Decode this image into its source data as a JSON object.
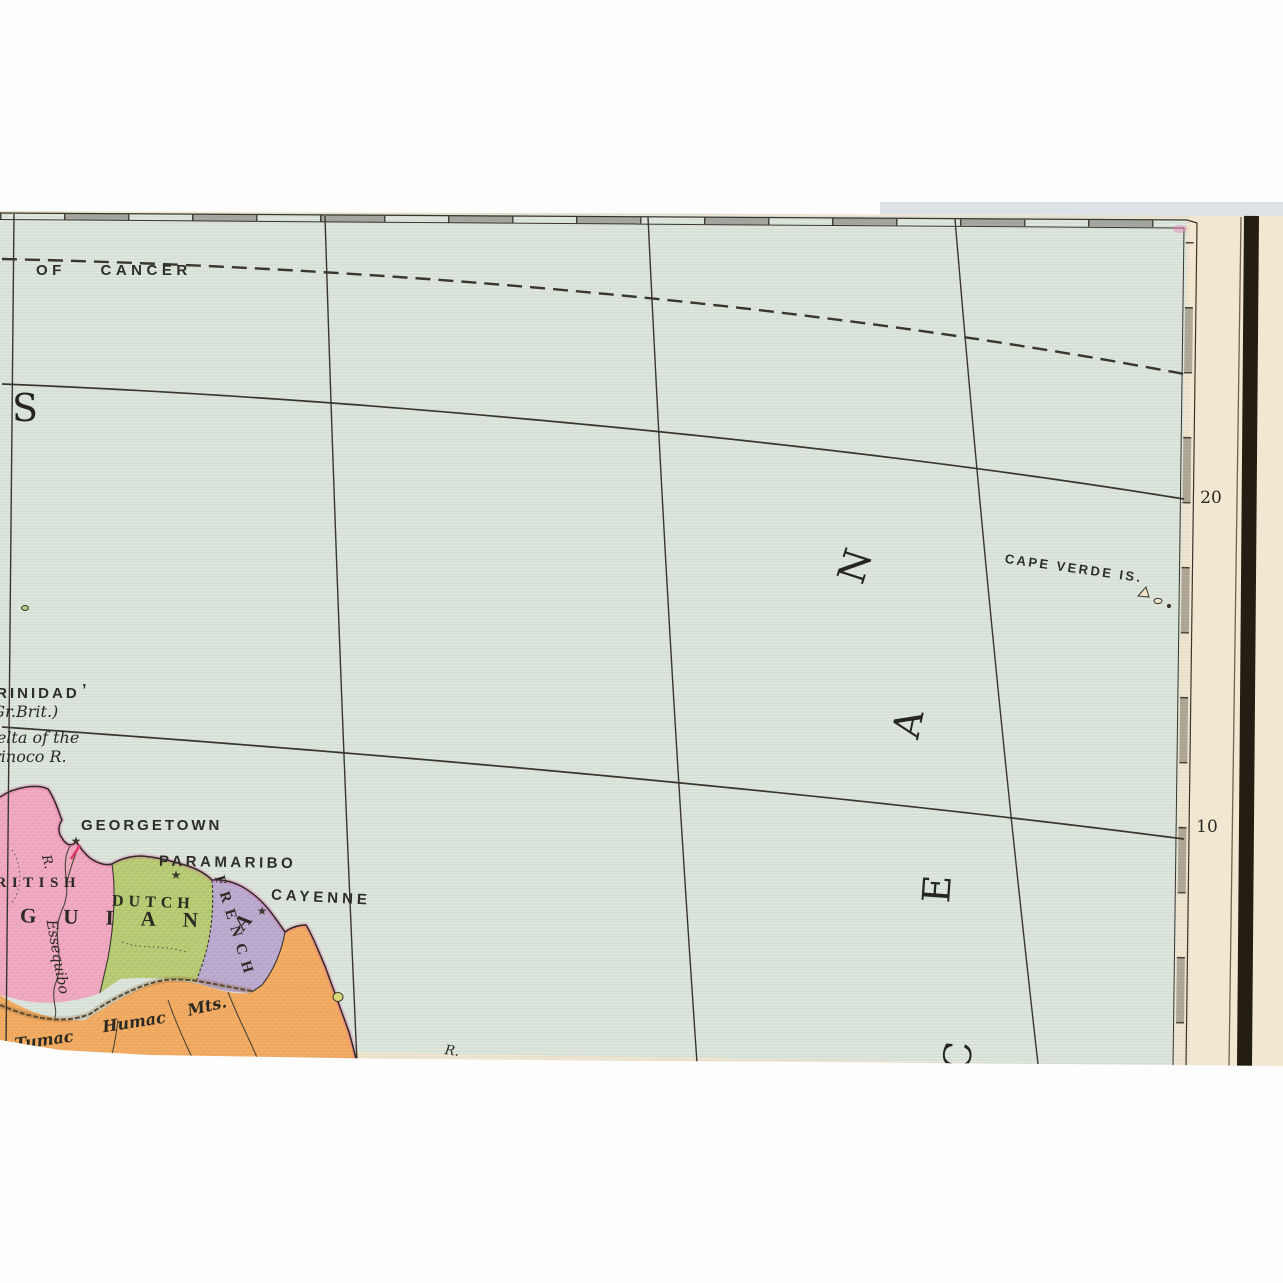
{
  "title": "Antique atlas map fragment - Guiana coast and North Atlantic",
  "colors": {
    "photo_bg": "#ffffff",
    "paper_cream": "#f2e8d2",
    "ocean_green": "#dfe9e0",
    "british_guiana_pink": "#f6acc5",
    "dutch_guiana_green": "#bcd077",
    "french_guiana_purple": "#c0aed4",
    "brazil_orange": "#f8ae63",
    "line_ink": "#36322a",
    "binding_bar_black": "#241d13",
    "coast_tint_magenta": "#e060a8",
    "georgetown_mark_red": "#e23a68"
  },
  "graticule": {
    "tropic_label": "OF CANCER",
    "lat_labels": [
      "20",
      "10"
    ]
  },
  "ocean": {
    "word_letters": [
      "N",
      "A",
      "E",
      "C"
    ],
    "stray_letter": "S"
  },
  "islands": {
    "cape_verde": "CAPE VERDE IS.",
    "trinidad_tick": "’"
  },
  "places": {
    "trinidad": "TRINIDAD",
    "gr_brit": "(Gr.Brit.)",
    "delta_line1": "Delta of the",
    "delta_line2": "Orinoco R.",
    "georgetown": "GEORGETOWN",
    "paramaribo": "PARAMARIBO",
    "cayenne": "CAYENNE",
    "british": "BRITISH",
    "dutch": "DUTCH",
    "french": "FRENCH",
    "guiana_main": "GUIAN",
    "guiana_last_letter": "A",
    "essequibo_river": "Essequibo",
    "river_abbrev": "R.",
    "river_abbrev2": "R.",
    "mts_word1": "Tumac",
    "mts_word2": "Humac",
    "mts_word3": "Mts."
  },
  "icons": {
    "city_star": "★"
  }
}
